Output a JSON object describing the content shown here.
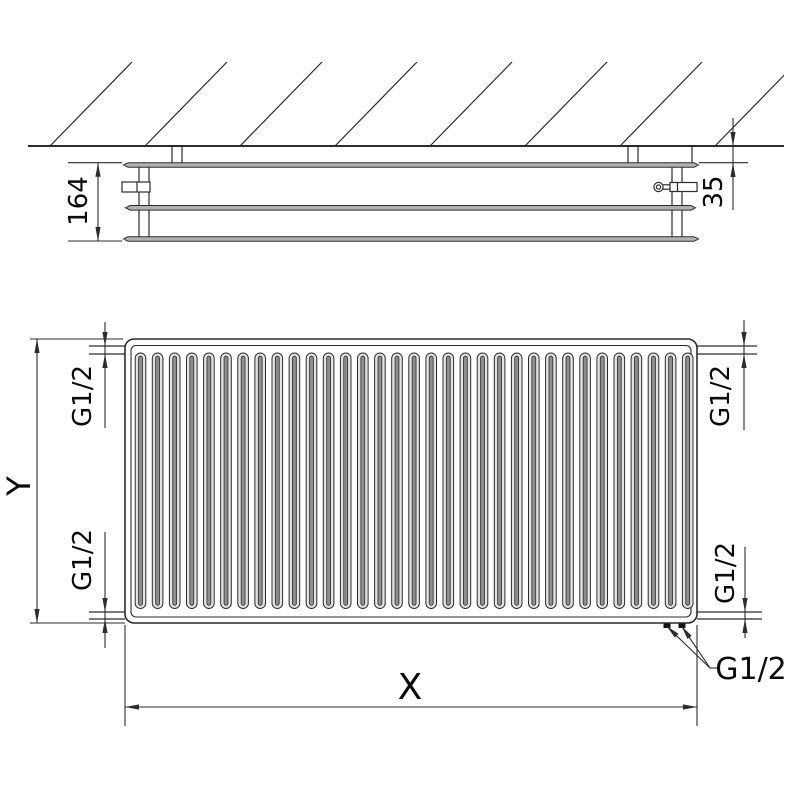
{
  "drawing": {
    "type": "panel-radiator technical dimension drawing, top view and front view",
    "labels": {
      "depth": "164",
      "wall_clearance": "35",
      "height_axis": "Y",
      "width_axis": "X",
      "conn_top_left": "G1/2",
      "conn_top_right": "G1/2",
      "conn_bottom_left": "G1/2",
      "conn_bottom_right": "G1/2",
      "conn_bottom_outlets": "G1/2"
    },
    "front_view": {
      "channel_count": 33
    },
    "colors": {
      "line": "#2c2c2c",
      "panel_fill": "#b1b1b1",
      "channel_light": "#e3e3e3",
      "channel_core": "#8e8e8e",
      "text": "#0b0b0b"
    }
  }
}
